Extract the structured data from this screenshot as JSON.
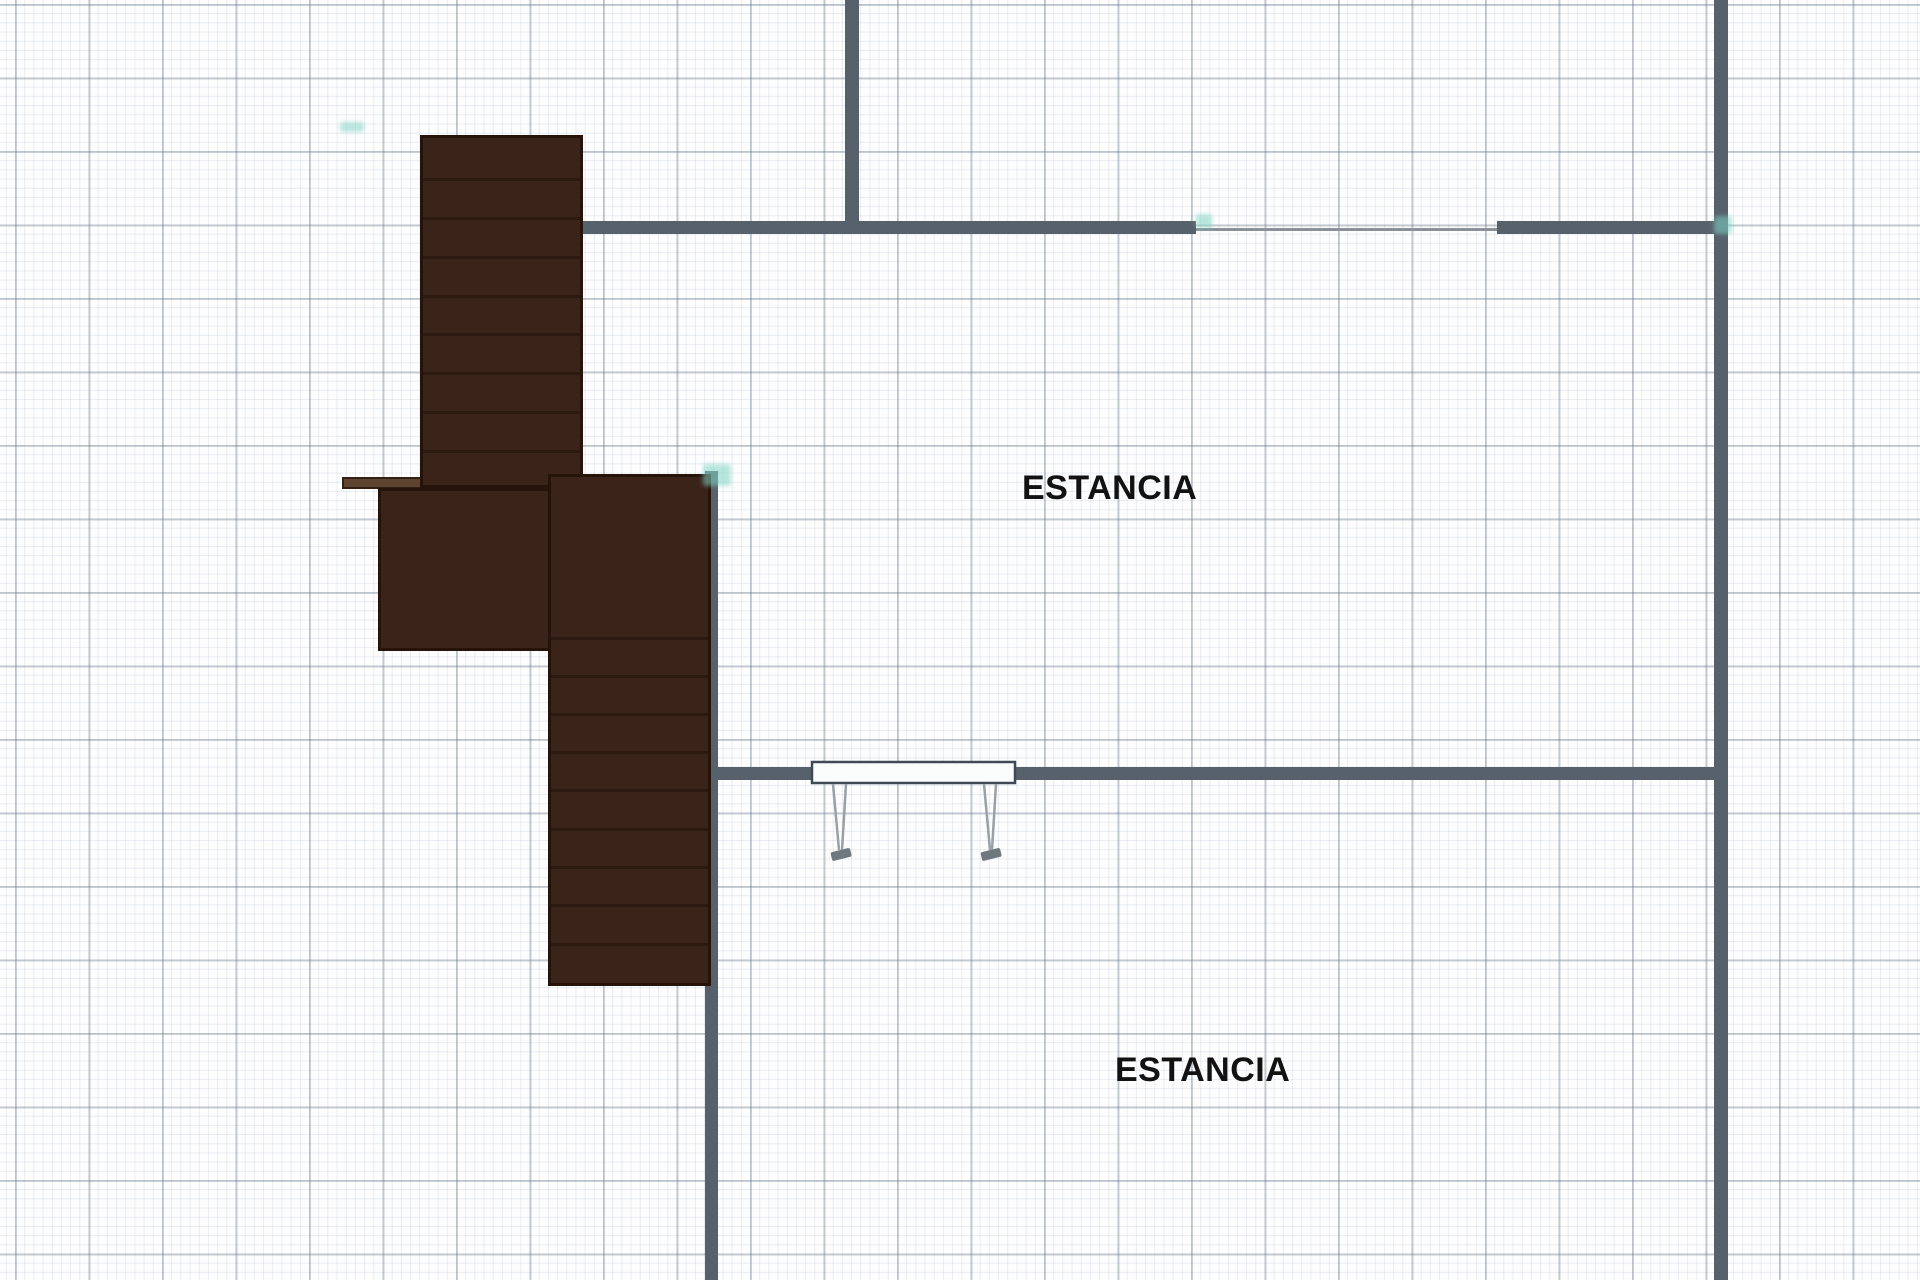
{
  "plan": {
    "colors": {
      "paper": "#fdfdfe",
      "grid_minor": "rgba(130,150,170,0.16)",
      "grid_major": "rgba(104,119,134,0.35)",
      "wall": "#57616b",
      "opening_line": "#8a9199",
      "stair_fill": "#3a241a",
      "stair_border": "#261309",
      "stair_tread": "#2c1a11",
      "handrail_fill": "#5e4330",
      "handrail_border": "#332014",
      "table_top_fill": "#fbfcfc",
      "table_top_stroke": "#3f4a54",
      "table_leg_stroke": "#99a0a7",
      "table_foot_fill": "#70787f",
      "endpoint_marker": "#7fd4c4",
      "label_text": "#121212"
    },
    "grid": {
      "minor_step_px": 9.1875,
      "major_step_px": 73.5
    },
    "rooms": [
      {
        "label": "ESTANCIA",
        "x": 1022,
        "y": 471
      },
      {
        "label": "ESTANCIA",
        "x": 1115,
        "y": 1053
      }
    ],
    "walls": [
      {
        "name": "wall-top-vertical",
        "x": 845,
        "y": 0,
        "w": 14,
        "h": 234
      },
      {
        "name": "wall-upper-horizontal-left",
        "x": 566,
        "y": 221,
        "w": 630,
        "h": 13
      },
      {
        "name": "wall-upper-horizontal-right",
        "x": 1497,
        "y": 221,
        "w": 231,
        "h": 13
      },
      {
        "name": "wall-right-vertical",
        "x": 1714,
        "y": 0,
        "w": 14,
        "h": 1280
      },
      {
        "name": "wall-middle-horizontal",
        "x": 705,
        "y": 767,
        "w": 1016,
        "h": 13
      },
      {
        "name": "wall-lower-vertical",
        "x": 705,
        "y": 471,
        "w": 13,
        "h": 809
      }
    ],
    "opening": {
      "name": "doorway-opening-line",
      "x": 1196,
      "y": 228,
      "w": 301,
      "h": 3
    },
    "stair": {
      "upper_flight": {
        "x": 420,
        "y": 135,
        "w": 163,
        "h": 353,
        "treads": [
          178,
          217,
          256,
          295,
          333,
          372,
          411,
          450
        ]
      },
      "handrail_bar": {
        "x": 342,
        "y": 477,
        "w": 80,
        "h": 12
      },
      "landing": {
        "x": 378,
        "y": 488,
        "w": 205,
        "h": 163
      },
      "lower_flight": {
        "x": 548,
        "y": 474,
        "w": 163,
        "h": 512,
        "treads": [
          637,
          675,
          713,
          751,
          789,
          828,
          866,
          904,
          943
        ]
      }
    },
    "table": {
      "top": {
        "x": 812,
        "y": 762,
        "w": 203,
        "h": 21
      },
      "legs": [
        {
          "lines": [
            [
              833,
              784,
              839,
              850
            ],
            [
              846,
              784,
              842,
              850
            ]
          ],
          "foot": [
            841,
            854
          ]
        },
        {
          "lines": [
            [
              984,
              784,
              990,
              850
            ],
            [
              996,
              784,
              992,
              850
            ]
          ],
          "foot": [
            991,
            854
          ]
        }
      ]
    },
    "markers": [
      {
        "x": 1196,
        "y": 214,
        "w": 16,
        "h": 14
      },
      {
        "x": 1714,
        "y": 216,
        "w": 18,
        "h": 18
      },
      {
        "x": 703,
        "y": 464,
        "w": 28,
        "h": 22
      },
      {
        "x": 340,
        "y": 122,
        "w": 24,
        "h": 10
      }
    ]
  }
}
